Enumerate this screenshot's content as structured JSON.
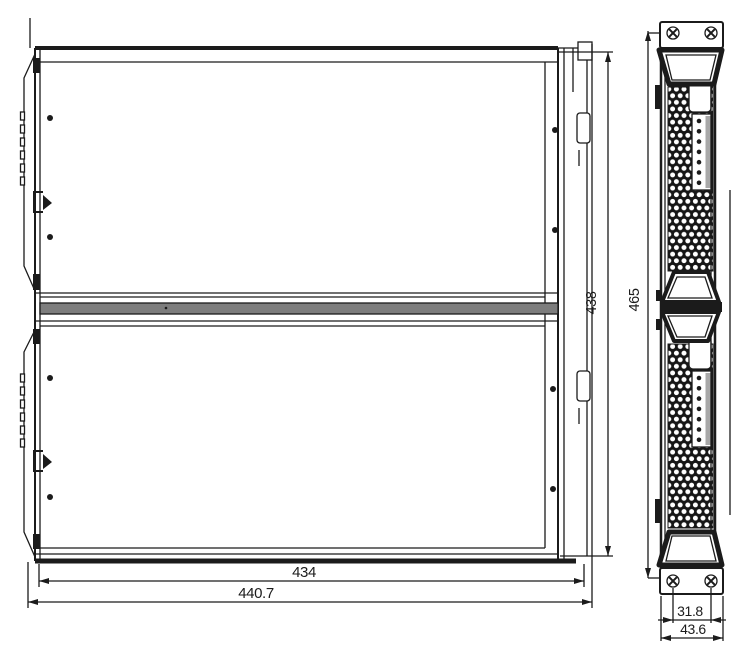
{
  "drawing": {
    "type": "engineering-dimension-drawing",
    "description": "Two-view mechanical outline drawing of a stacked two-module chassis with mounting brackets",
    "colors": {
      "line": "#1b1b1b",
      "background": "#ffffff",
      "divider_gray": "#7d7d7d",
      "connector_gray": "#a8a8a8"
    },
    "views": {
      "front": {
        "dims": {
          "inner_width": "434",
          "outer_width": "440.7",
          "inner_height": "438",
          "outer_height": "465"
        }
      },
      "side": {
        "dims": {
          "screw_spacing": "31.8",
          "outer_depth": "43.6"
        }
      }
    },
    "icons": {
      "phillips_screw": "phillips-screw-icon",
      "screw_dot": "screw-dot-icon",
      "vent_mesh": "perforated-mesh",
      "handle": "pull-handle"
    }
  }
}
